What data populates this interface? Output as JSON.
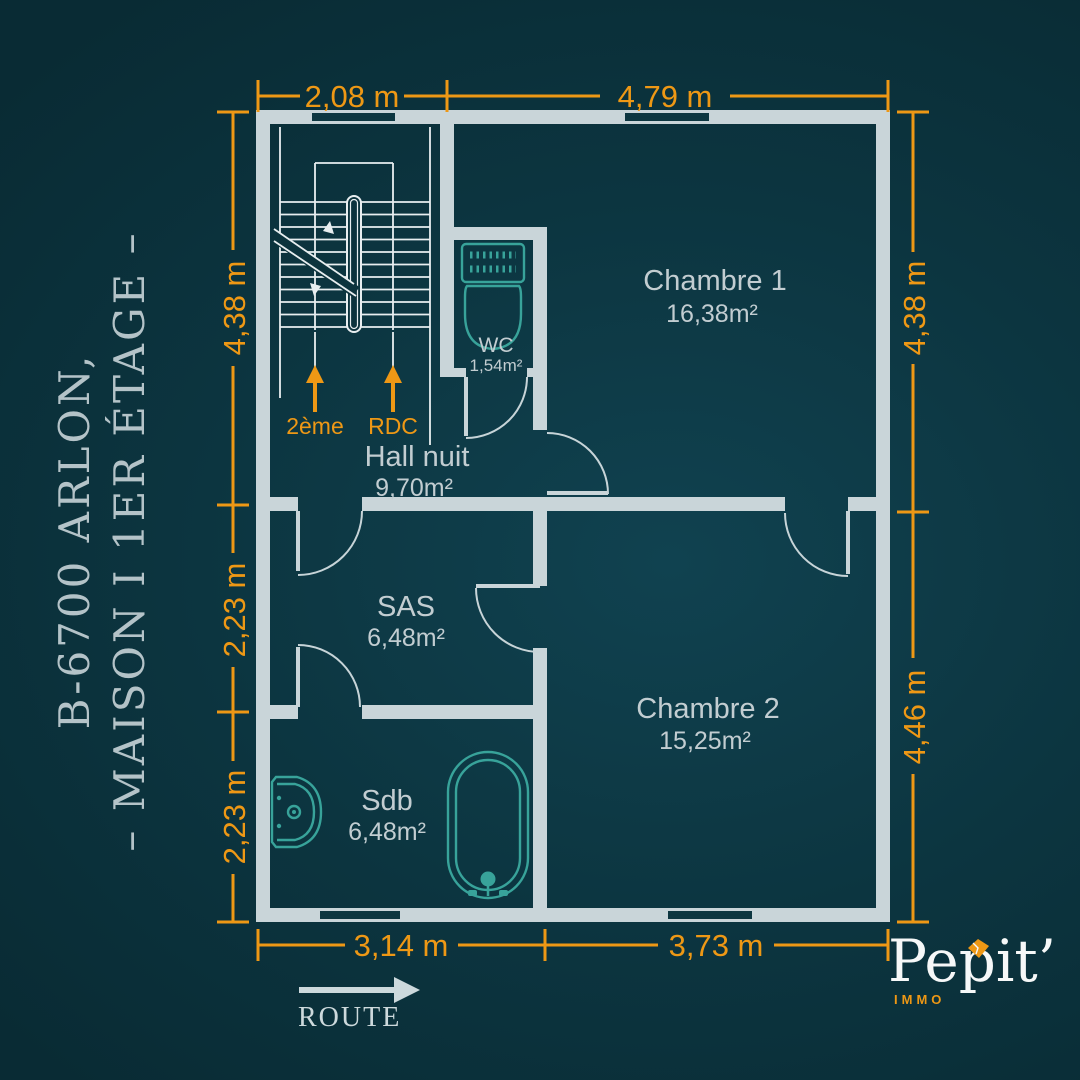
{
  "title": {
    "line1": "B-6700 ARLON,",
    "line2": "– MAISON I 1ER ÉTAGE –"
  },
  "plan": {
    "rooms": [
      {
        "name": "Chambre 1",
        "area": "16,38m²"
      },
      {
        "name": "WC",
        "area": "1,54m²"
      },
      {
        "name": "Hall nuit",
        "area": "9,70m²"
      },
      {
        "name": "SAS",
        "area": "6,48m²"
      },
      {
        "name": "Chambre 2",
        "area": "15,25m²"
      },
      {
        "name": "Sdb",
        "area": "6,48m²"
      }
    ],
    "stairs": {
      "up_label": "2ème",
      "down_label": "RDC"
    },
    "dimensions": {
      "top": [
        "2,08 m",
        "4,79 m"
      ],
      "left": [
        "4,38 m",
        "2,23 m",
        "2,23 m"
      ],
      "right": [
        "4,38 m",
        "4,46 m"
      ],
      "bottom": [
        "3,14 m",
        "3,73 m"
      ]
    }
  },
  "route_label": "ROUTE",
  "logo": {
    "name": "Pepit’",
    "sub": "IMMO"
  },
  "colors": {
    "background_teal": "#0c3540",
    "wall_grey": "#c9d5d9",
    "accent_orange": "#ee9815",
    "fixture_teal": "#38a39a",
    "label_grey": "#c2cdd1",
    "logo_white": "#f6f8f8"
  }
}
